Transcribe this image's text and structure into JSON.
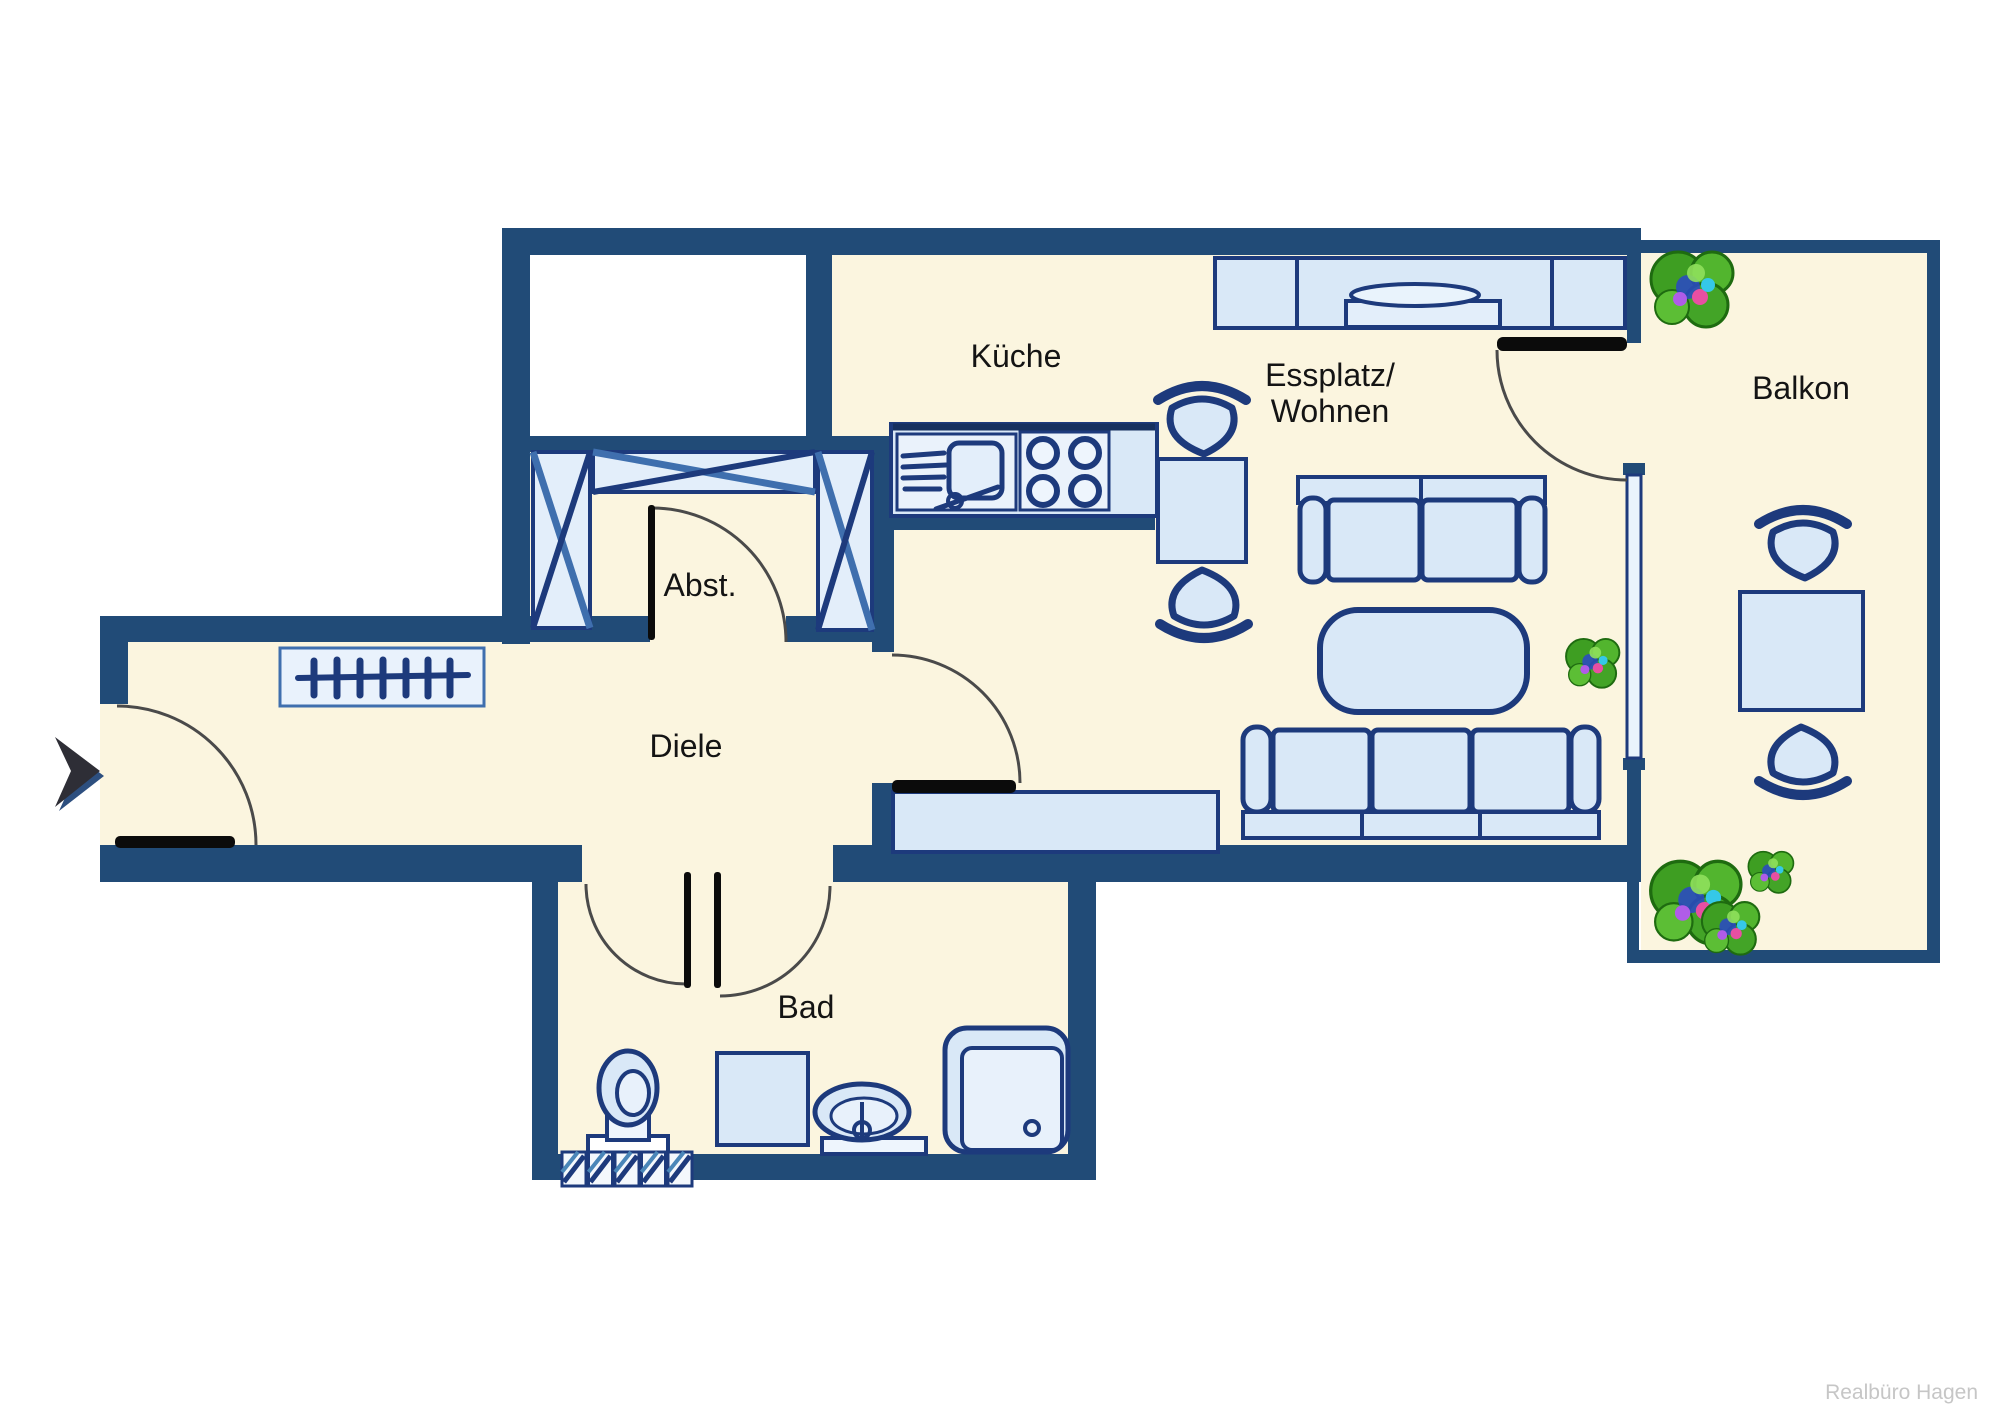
{
  "type": "floor-plan",
  "rooms": {
    "kueche": {
      "label": "Küche"
    },
    "wohnen": {
      "line1": "Essplatz/",
      "line2": "Wohnen"
    },
    "balkon": {
      "label": "Balkon"
    },
    "abstellraum": {
      "label": "Abst."
    },
    "diele": {
      "label": "Diele"
    },
    "bad": {
      "label": "Bad"
    }
  },
  "watermark": {
    "text": "Realbüro Hagen"
  },
  "entrance": {
    "symbol": "arrow-right-icon"
  },
  "icons": [
    "plant-icon",
    "chair-icon",
    "sofa-icon",
    "toilet-icon",
    "shower-icon",
    "washbasin-icon",
    "radiator-icon",
    "wardrobe-x-icon",
    "coat-rack-icon",
    "stove-icon",
    "sink-icon"
  ],
  "colors": {
    "wall": "#214b77",
    "floor": "#fbf5df",
    "furniture_fill": "#d9e8f7",
    "furniture_stroke": "#1d3a7c",
    "accent_blue": "#4b7fb5",
    "plant_green": "#43a427",
    "door_leaf": "#0b0b0b",
    "watermark_gray": "#c6c6c6"
  }
}
